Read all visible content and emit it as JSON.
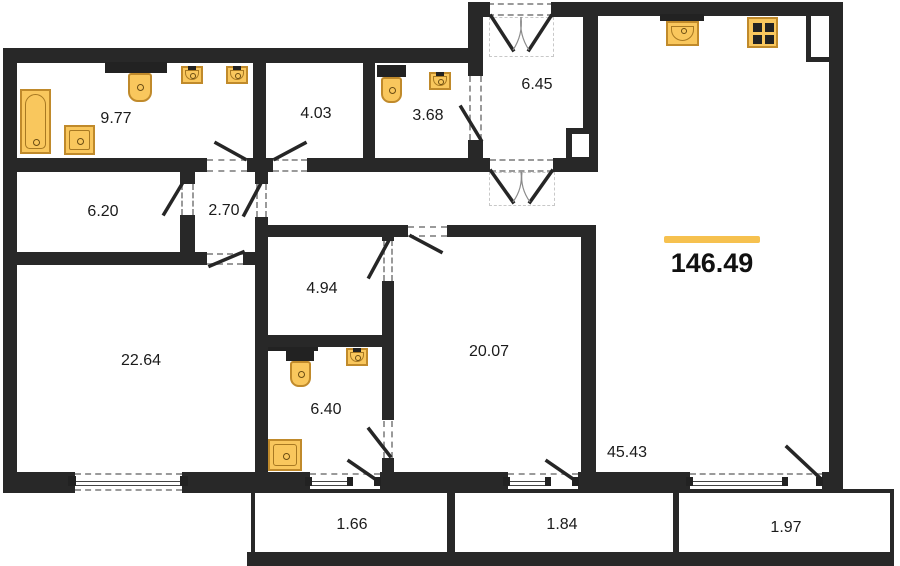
{
  "title": "apartment-floor-plan",
  "total": {
    "area": "146.49"
  },
  "rooms": {
    "bathroom_main": {
      "area": "9.77"
    },
    "dressing": {
      "area": "4.03"
    },
    "wc": {
      "area": "3.68"
    },
    "entry_hall": {
      "area": "6.45"
    },
    "hallway": {
      "area": "6.20"
    },
    "corridor": {
      "area": "2.70"
    },
    "bedroom_large": {
      "area": "22.64"
    },
    "wardrobe": {
      "area": "4.94"
    },
    "bedroom": {
      "area": "20.07"
    },
    "bathroom_laundry": {
      "area": "6.40"
    },
    "living_kitchen": {
      "area": "45.43"
    }
  },
  "balconies": {
    "left": {
      "area": "1.66"
    },
    "middle": {
      "area": "1.84"
    },
    "right": {
      "area": "1.97"
    }
  },
  "fixtures": [
    "bathtub",
    "pedestal-sink",
    "wall-sink",
    "toilet",
    "washing-machine",
    "kitchen-sink",
    "stove"
  ],
  "colors": {
    "wall": "#282828",
    "accent": "#F6C14F",
    "fixture_fill": "#F9C75D",
    "fixture_border": "#C08A2B"
  }
}
